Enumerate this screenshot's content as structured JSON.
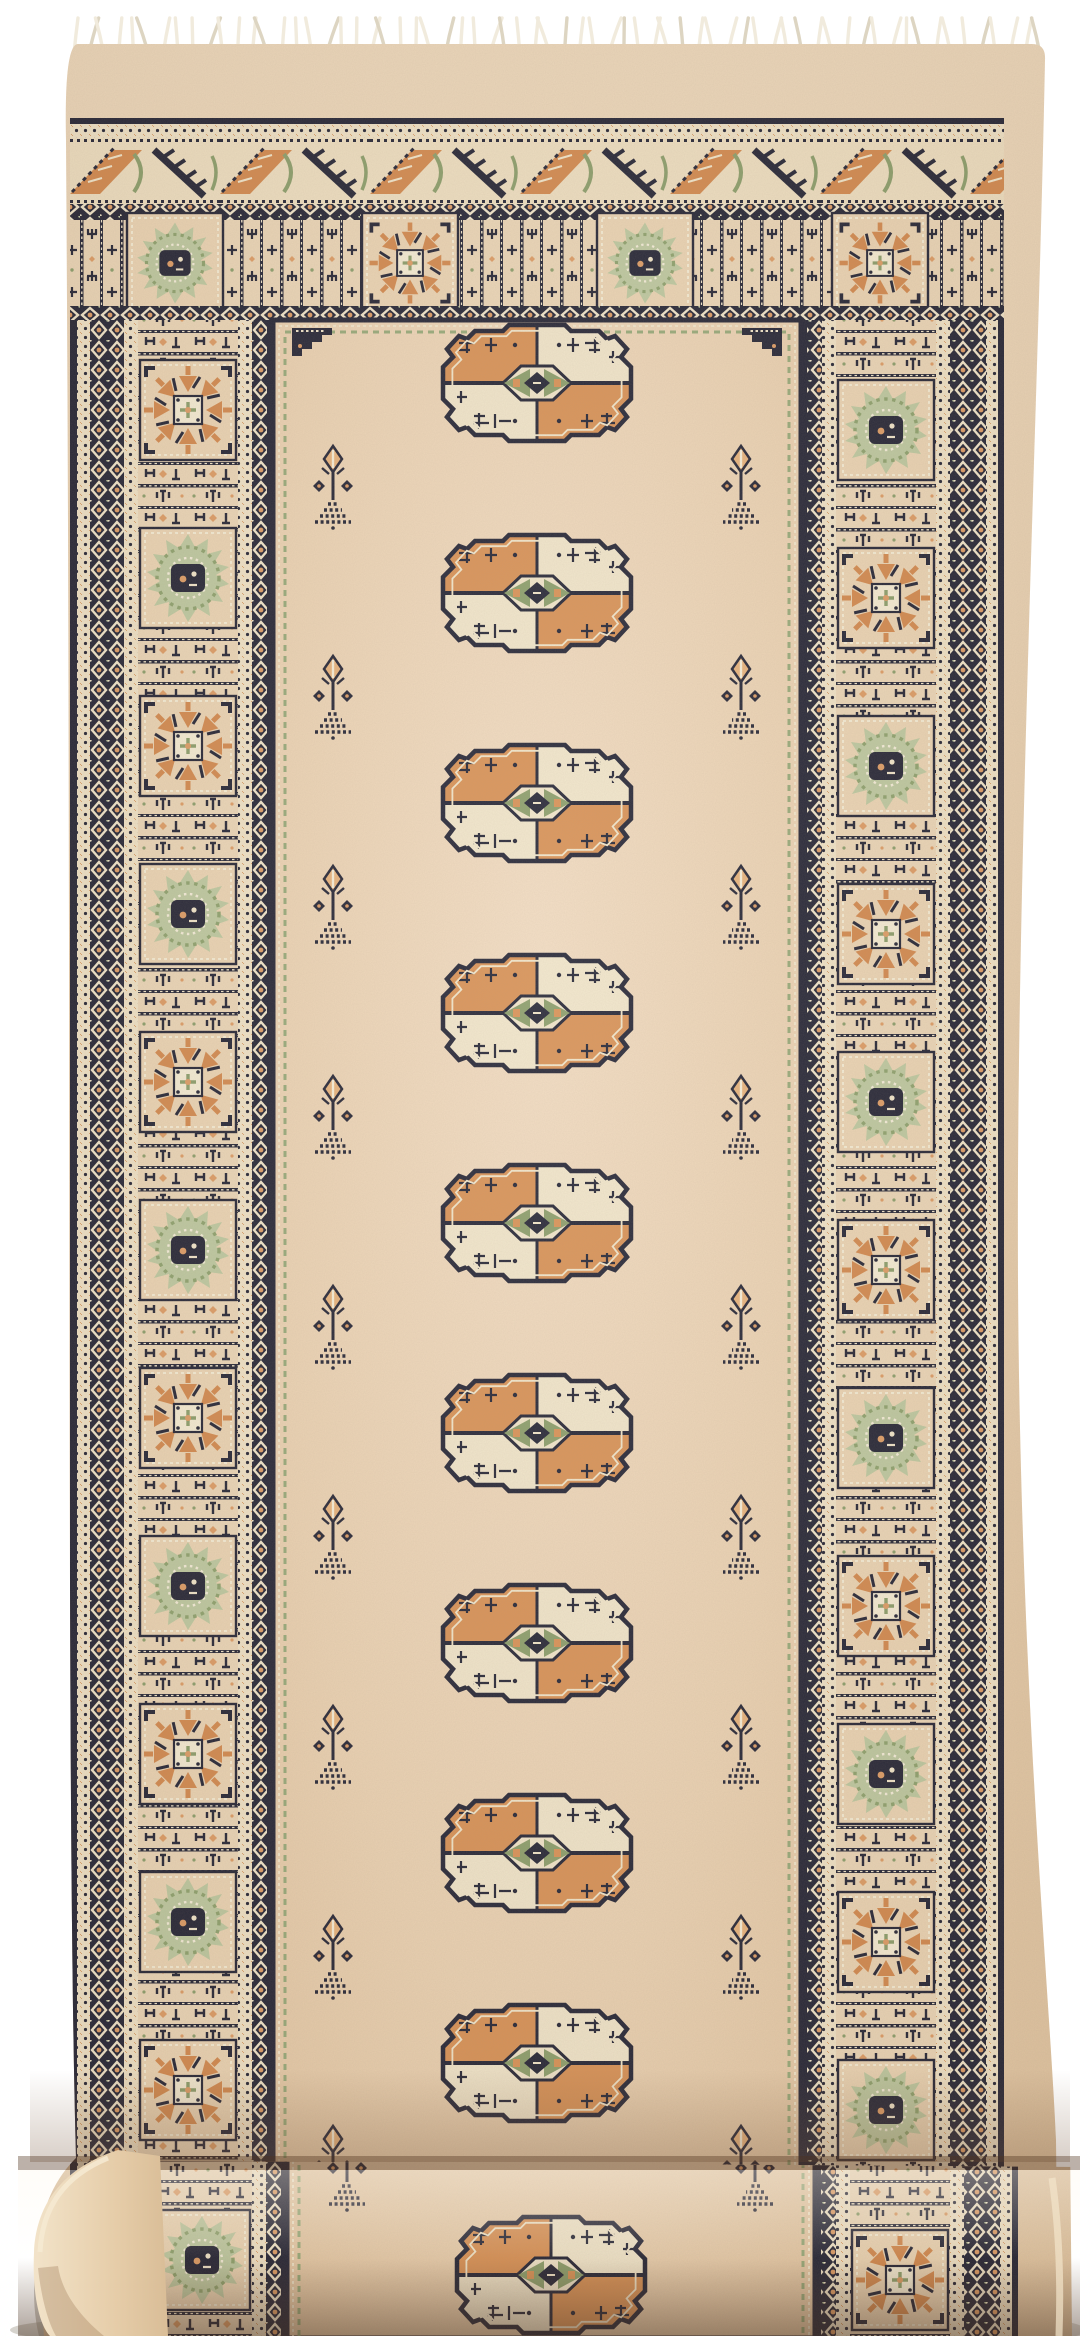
{
  "scene": {
    "type": "product-photograph",
    "subject": "Hand-knotted Bokhara-style wool runner rug with a single column of oval guls, white knotted fringe at the top, partially rolled up at the bottom, photographed on a plain white background",
    "background_color": "#ffffff"
  },
  "palette": {
    "white_bg": "#ffffff",
    "field": "#e9cfae",
    "field_light": "#f2dcc2",
    "margin": "#e7cdab",
    "cream": "#f2e7cc",
    "navy": "#1b1d30",
    "rust": "#d2864a",
    "rust_light": "#e4ad7d",
    "sage": "#879c68",
    "sage_pale": "#bcc9a0",
    "fringe": "#f1ebdd",
    "shadow": "#9a9284"
  },
  "fringe": {
    "side": "top",
    "strand_count": 66
  },
  "top_border": {
    "bands": [
      "meander-band",
      "compartment-band"
    ],
    "compartments": [
      "green-medallion",
      "orange-rosette",
      "green-medallion",
      "orange-rosette"
    ]
  },
  "side_borders": {
    "left": {
      "first_motif": "orange-rosette",
      "motif_count": 12,
      "alternation": [
        "orange-rosette",
        "green-medallion"
      ]
    },
    "right": {
      "first_motif": "green-medallion",
      "motif_count": 12,
      "alternation": [
        "green-medallion",
        "orange-rosette"
      ]
    }
  },
  "field": {
    "gul_columns": 1,
    "gul_count_full": 9,
    "gul_count_partial": 1,
    "sprig_pair_count": 9,
    "corner_bracket_count": 2
  },
  "roll": {
    "present": true,
    "end_cap_side": "left",
    "fold_y_px": 2160
  }
}
